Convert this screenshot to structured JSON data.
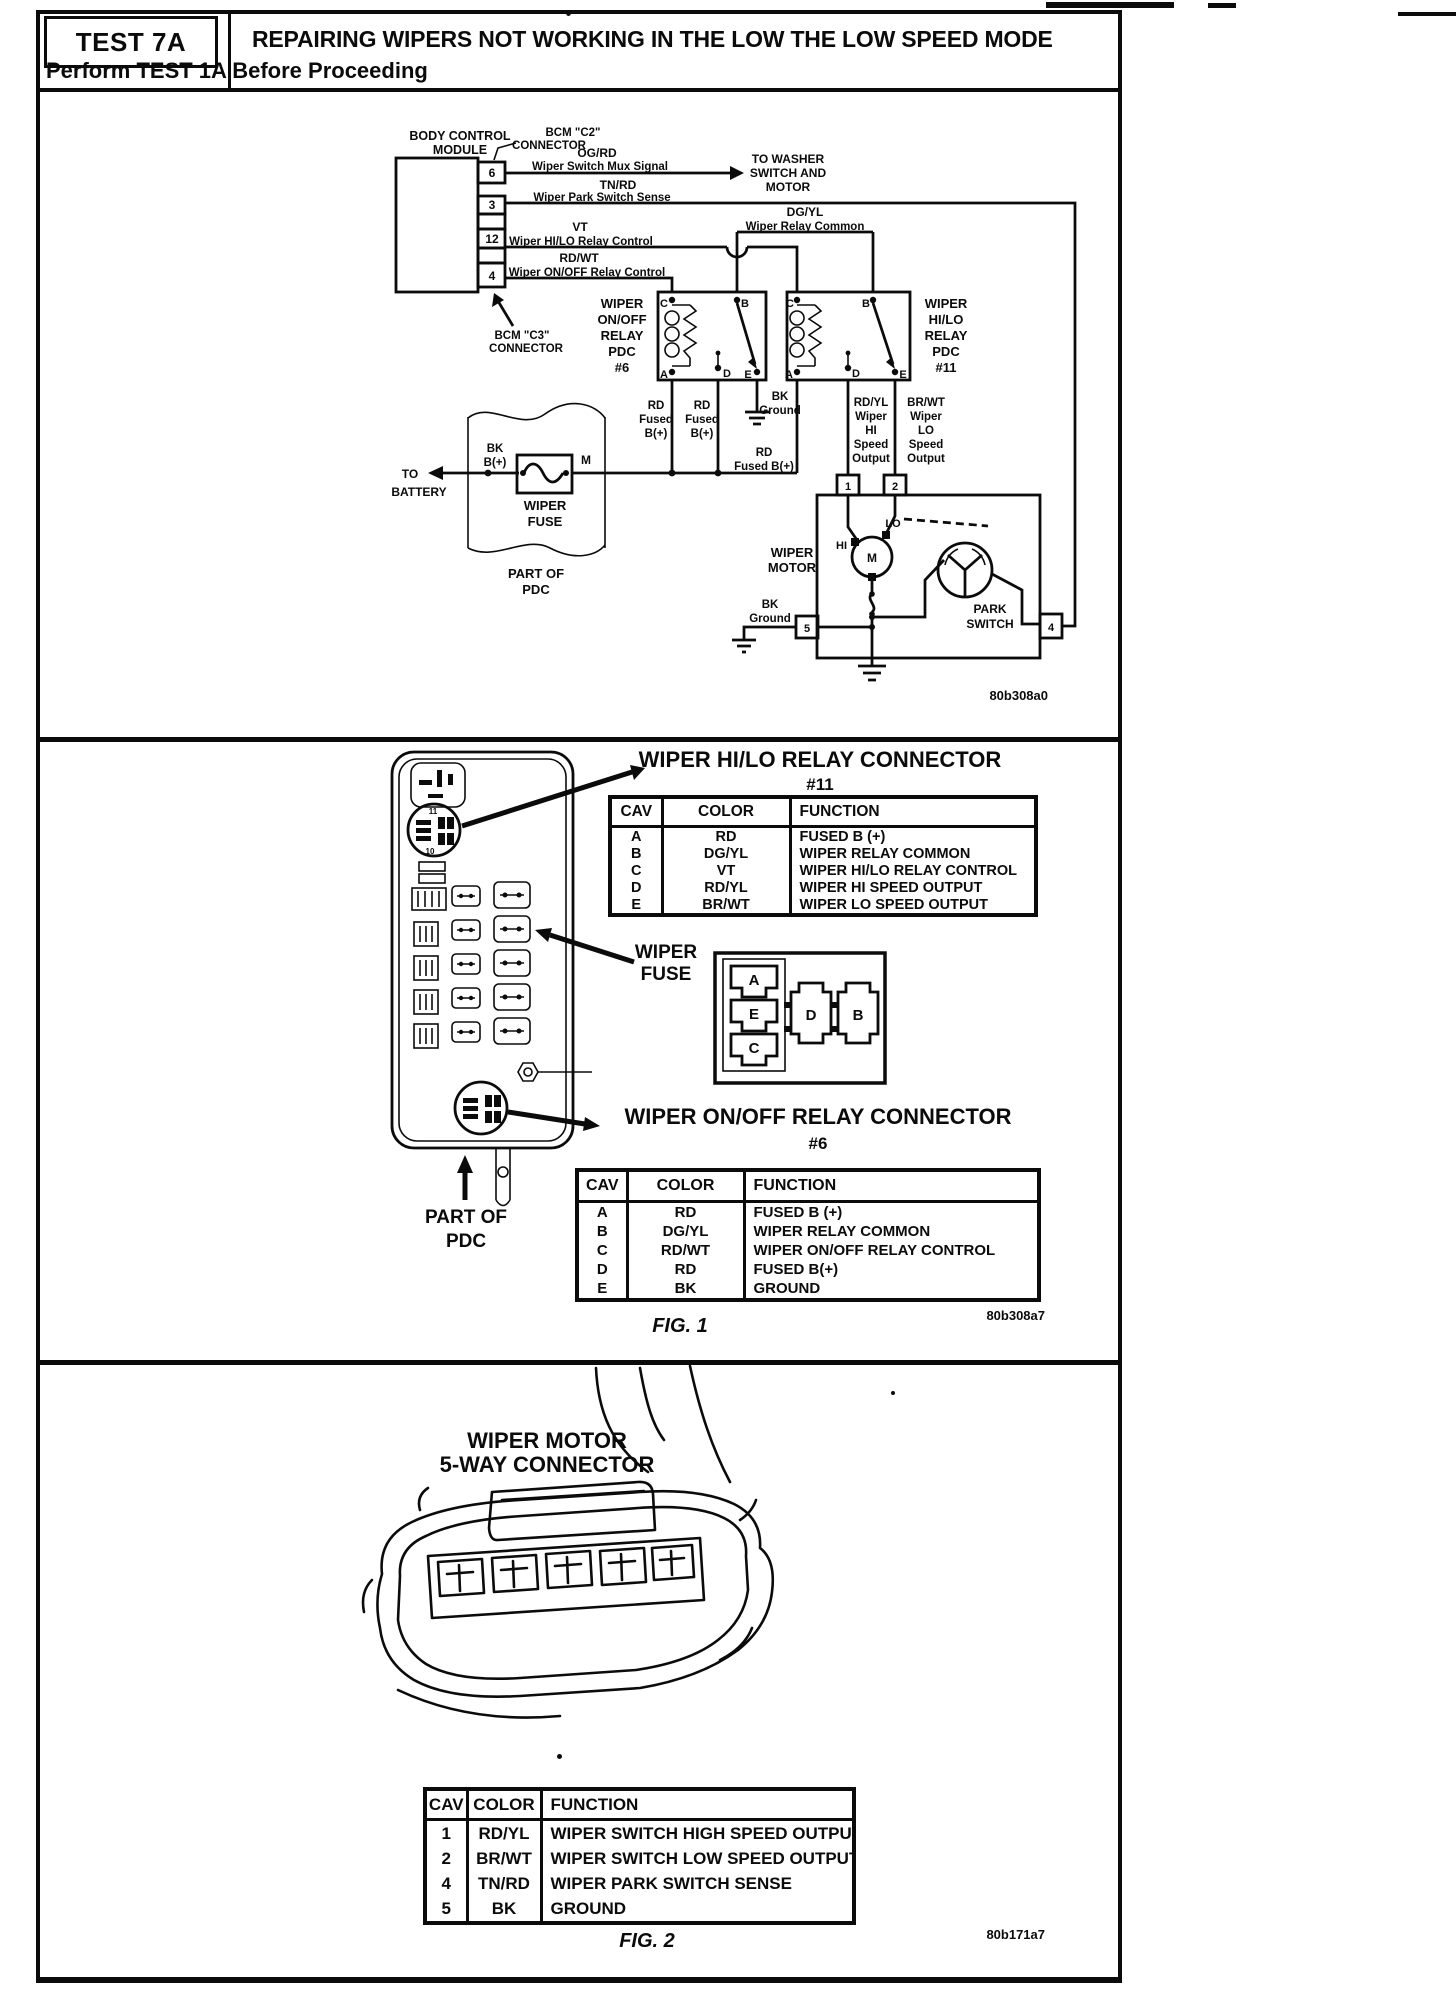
{
  "header": {
    "test_label": "TEST 7A",
    "title": "REPAIRING WIPERS NOT WORKING IN THE LOW THE LOW SPEED MODE",
    "subtitle": "Perform TEST 1A Before Proceeding"
  },
  "colors": {
    "ink": "#0b0b0b",
    "paper": "#ffffff"
  },
  "sch": {
    "bcm1": "BODY CONTROL",
    "bcm2": "MODULE",
    "c2a": "BCM \"C2\"",
    "c2b": "CONNECTOR",
    "c3a": "BCM \"C3\"",
    "c3b": "CONNECTOR",
    "pin_mux": "6",
    "pin_park": "3",
    "pin_hilo": "12",
    "pin_onoff": "4",
    "mux_color": "OG/RD",
    "mux_name": "Wiper Switch Mux Signal",
    "washer1": "TO WASHER",
    "washer2": "SWITCH AND",
    "washer3": "MOTOR",
    "park_color": "TN/RD",
    "park_name": "Wiper Park Switch Sense",
    "common_color": "DG/YL",
    "common_name": "Wiper Relay Common",
    "hilo_color": "VT",
    "hilo_name": "Wiper HI/LO Relay Control",
    "onoff_color": "RD/WT",
    "onoff_name": "Wiper ON/OFF Relay Control",
    "relay6": [
      "WIPER",
      "ON/OFF",
      "RELAY",
      "PDC",
      "#6"
    ],
    "relay11": [
      "WIPER",
      "HI/LO",
      "RELAY",
      "PDC",
      "#11"
    ],
    "t_c": "C",
    "t_b": "B",
    "t_a": "A",
    "t_d": "D",
    "t_e": "E",
    "rd": "RD",
    "fused": "Fused",
    "bplus": "B(+)",
    "bk": "BK",
    "ground": "Ground",
    "fused_b": "Fused B(+)",
    "rdyl": [
      "RD/YL",
      "Wiper",
      "HI",
      "Speed",
      "Output"
    ],
    "brwt": [
      "BR/WT",
      "Wiper",
      "LO",
      "Speed",
      "Output"
    ],
    "to": "TO",
    "battery": "BATTERY",
    "m_term": "M",
    "fuse1": "WIPER",
    "fuse2": "FUSE",
    "pdc1": "PART OF",
    "pdc2": "PDC",
    "mpin1": "1",
    "mpin2": "2",
    "mpin5": "5",
    "mpin4": "4",
    "motor1": "WIPER",
    "motor2": "MOTOR",
    "hi": "HI",
    "lo": "LO",
    "m": "M",
    "park1": "PARK",
    "park2": "SWITCH",
    "code": "80b308a0"
  },
  "fig1": {
    "title11": "WIPER HI/LO RELAY CONNECTOR",
    "num11": "#11",
    "headers": [
      "CAV",
      "COLOR",
      "FUNCTION"
    ],
    "table11": [
      [
        "A",
        "RD",
        "FUSED B (+)"
      ],
      [
        "B",
        "DG/YL",
        "WIPER RELAY COMMON"
      ],
      [
        "C",
        "VT",
        "WIPER HI/LO RELAY CONTROL"
      ],
      [
        "D",
        "RD/YL",
        "WIPER HI SPEED OUTPUT"
      ],
      [
        "E",
        "BR/WT",
        "WIPER LO SPEED OUTPUT"
      ]
    ],
    "fuse1": "WIPER",
    "fuse2": "FUSE",
    "cav": {
      "a": "A",
      "e": "E",
      "c": "C",
      "d": "D",
      "b": "B"
    },
    "socket_num_top": "11",
    "socket_num_bottom": "10",
    "title6": "WIPER ON/OFF RELAY CONNECTOR",
    "num6": "#6",
    "table6": [
      [
        "A",
        "RD",
        "FUSED B (+)"
      ],
      [
        "B",
        "DG/YL",
        "WIPER RELAY COMMON"
      ],
      [
        "C",
        "RD/WT",
        "WIPER ON/OFF RELAY CONTROL"
      ],
      [
        "D",
        "RD",
        "FUSED B(+)"
      ],
      [
        "E",
        "BK",
        "GROUND"
      ]
    ],
    "pdc1": "PART OF",
    "pdc2": "PDC",
    "fig": "FIG. 1",
    "code": "80b308a7"
  },
  "fig2": {
    "heading1": "WIPER MOTOR",
    "heading2": "5-WAY CONNECTOR",
    "headers": [
      "CAV",
      "COLOR",
      "FUNCTION"
    ],
    "rows": [
      [
        "1",
        "RD/YL",
        "WIPER SWITCH HIGH SPEED OUTPUT"
      ],
      [
        "2",
        "BR/WT",
        "WIPER SWITCH LOW SPEED OUTPUT"
      ],
      [
        "4",
        "TN/RD",
        "WIPER PARK SWITCH SENSE"
      ],
      [
        "5",
        "BK",
        "GROUND"
      ]
    ],
    "fig": "FIG. 2",
    "code": "80b171a7"
  }
}
